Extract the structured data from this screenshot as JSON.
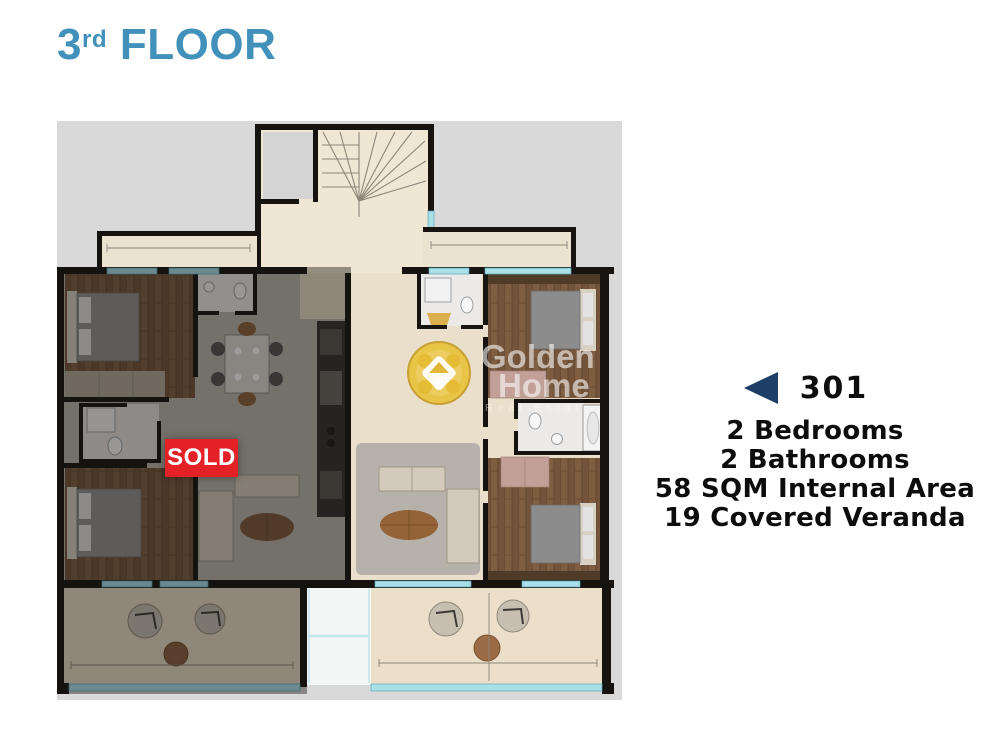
{
  "header": {
    "floor_number": "3",
    "floor_ordinal": "rd",
    "floor_word": "FLOOR"
  },
  "plan": {
    "sold_badge_label": "SOLD",
    "watermark": {
      "line1": "Golden",
      "line2": "Home",
      "tagline": "Real Estate"
    }
  },
  "unit_panel": {
    "unit_number": "301",
    "arrow_icon": "left-triangle",
    "details": [
      "2 Bedrooms",
      "2 Bathrooms",
      "58 SQM Internal Area",
      "19 Covered Veranda"
    ]
  },
  "colors": {
    "title_blue": "#4291bb",
    "arrow_navy": "#1d3e66",
    "sold_red": "#e32127",
    "text_dark": "#0d0d0d",
    "plan_backdrop_gray": "#d9d9d9",
    "wall_black": "#161310",
    "floor_beige": "#eadfca",
    "floor_wood": "#73543b",
    "window_cyan": "#aadfe8",
    "logo_gold": "#e8c340"
  }
}
